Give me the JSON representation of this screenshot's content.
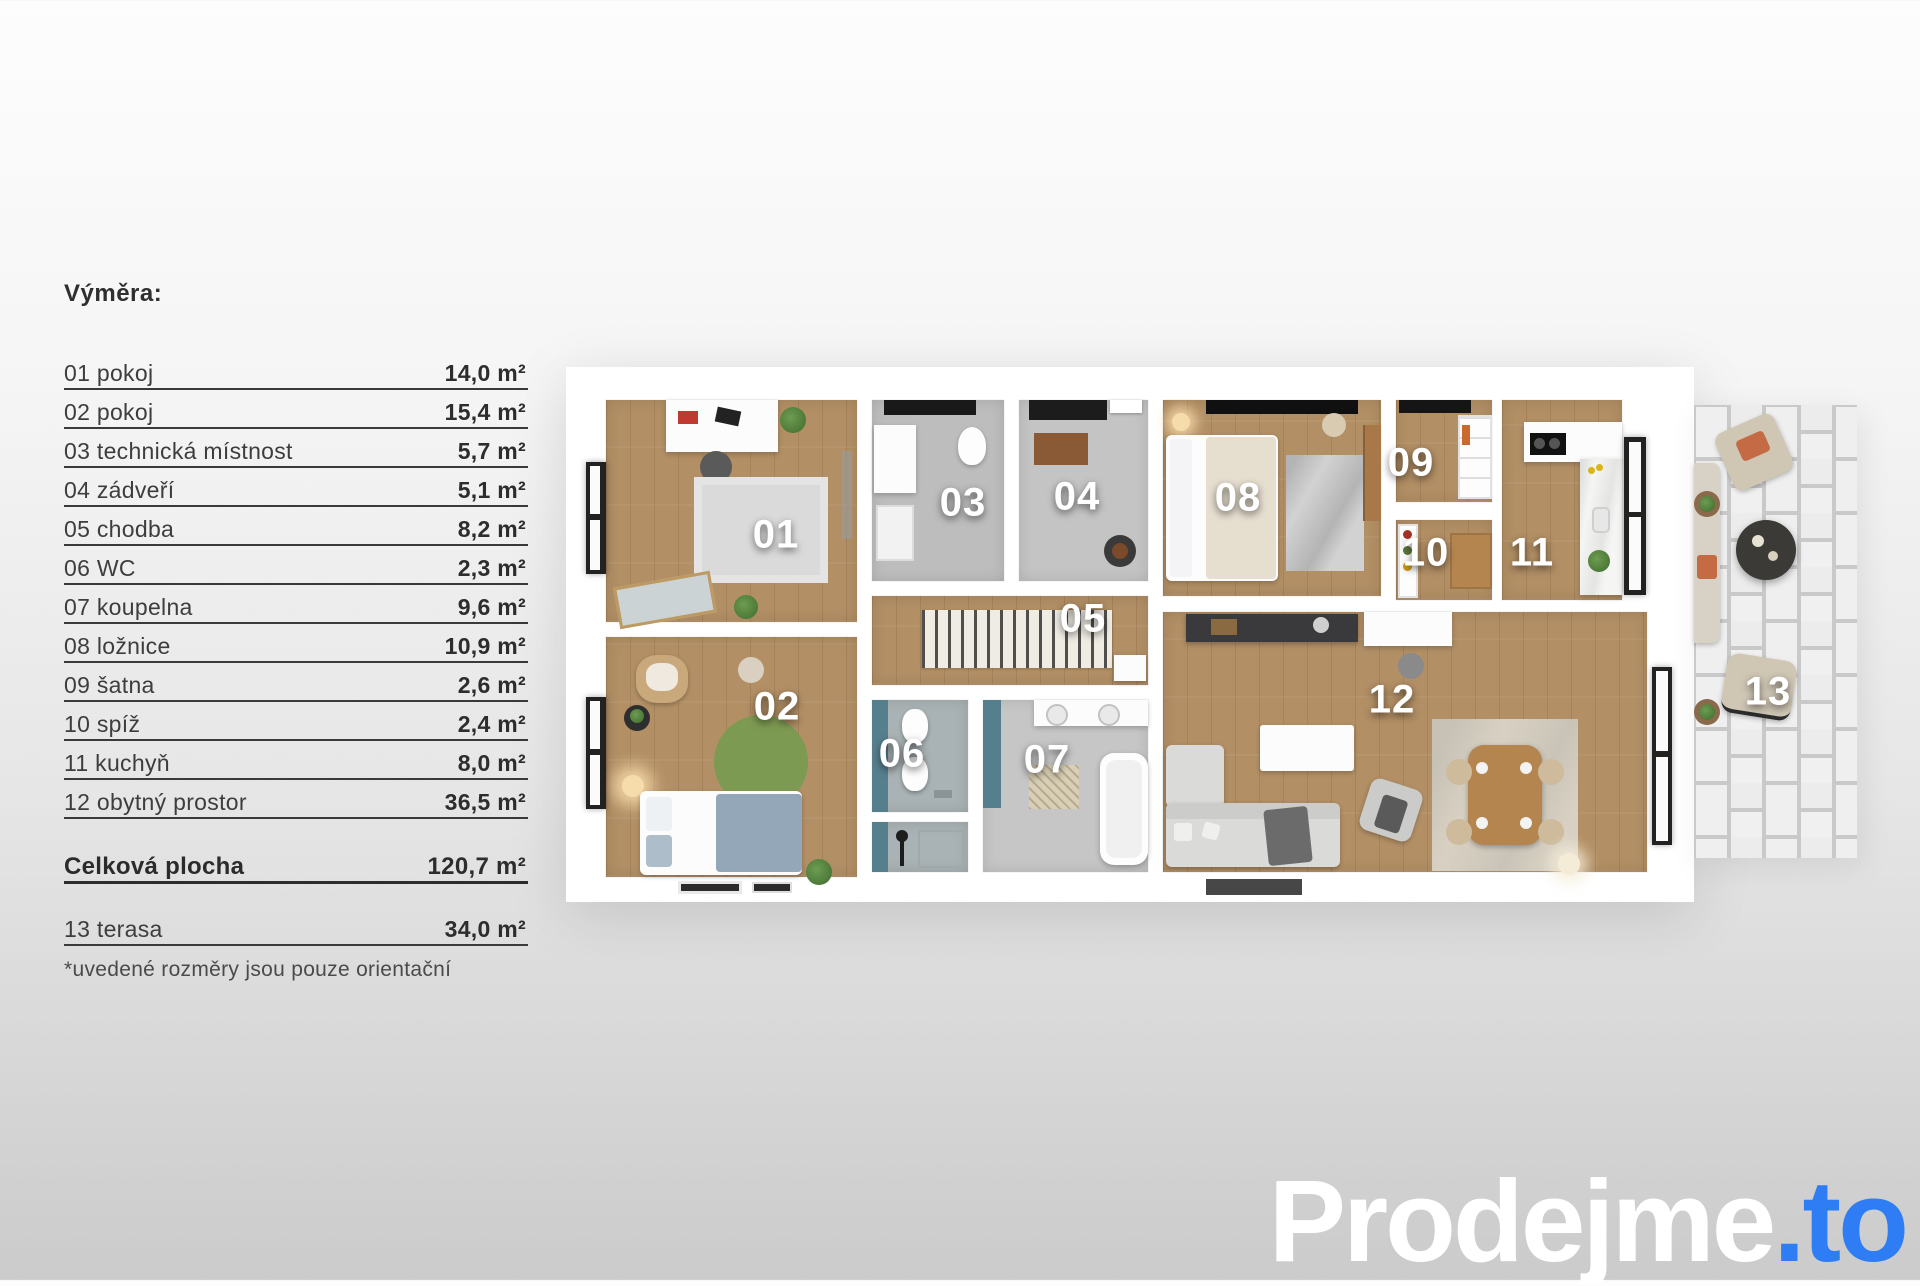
{
  "legend": {
    "title": "Výměra:",
    "rows": [
      {
        "label": "01 pokoj",
        "value": "14,0 m²"
      },
      {
        "label": "02 pokoj",
        "value": "15,4 m²"
      },
      {
        "label": "03 technická místnost",
        "value": "5,7 m²"
      },
      {
        "label": "04 zádveří",
        "value": "5,1 m²"
      },
      {
        "label": "05 chodba",
        "value": "8,2 m²"
      },
      {
        "label": "06 WC",
        "value": "2,3 m²"
      },
      {
        "label": "07 koupelna",
        "value": "9,6 m²"
      },
      {
        "label": "08 ložnice",
        "value": "10,9 m²"
      },
      {
        "label": "09 šatna",
        "value": "2,6 m²"
      },
      {
        "label": "10 spíž",
        "value": "2,4 m²"
      },
      {
        "label": "11 kuchyň",
        "value": "8,0 m²"
      },
      {
        "label": "12 obytný prostor",
        "value": "36,5 m²"
      }
    ],
    "total": {
      "label": "Celková plocha",
      "value": "120,7 m²"
    },
    "extra": {
      "label": "13 terasa",
      "value": "34,0 m²"
    },
    "footnote": "*uvedené rozměry jsou pouze orientační"
  },
  "plan": {
    "rooms": [
      {
        "number": "01",
        "name": "pokoj"
      },
      {
        "number": "02",
        "name": "pokoj"
      },
      {
        "number": "03",
        "name": "technická místnost"
      },
      {
        "number": "04",
        "name": "zádveří"
      },
      {
        "number": "05",
        "name": "chodba"
      },
      {
        "number": "06",
        "name": "WC"
      },
      {
        "number": "07",
        "name": "koupelna"
      },
      {
        "number": "08",
        "name": "ložnice"
      },
      {
        "number": "09",
        "name": "šatna"
      },
      {
        "number": "10",
        "name": "spíž"
      },
      {
        "number": "11",
        "name": "kuchyň"
      },
      {
        "number": "12",
        "name": "obytný prostor"
      },
      {
        "number": "13",
        "name": "terasa"
      }
    ]
  },
  "logo": {
    "text_white": "Prodejme",
    "text_accent": ".to"
  },
  "colors": {
    "accent_blue": "#2e7df5",
    "wood_floor": "#b28f65",
    "concrete_floor": "#c0c0c0",
    "teal_wall": "#567f8e",
    "terrace_tile": "#eeeeee"
  }
}
